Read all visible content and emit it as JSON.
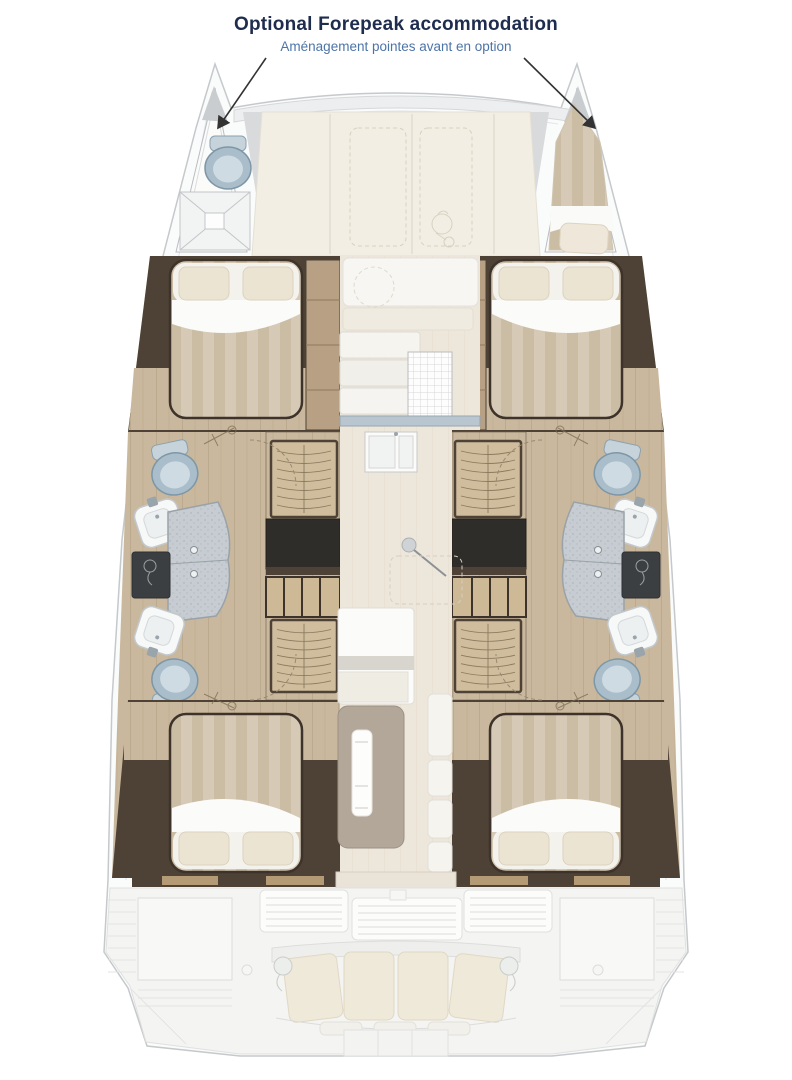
{
  "annotation": {
    "title": "Optional Forepeak accommodation",
    "subtitle": "Aménagement pointes avant en option"
  },
  "colors": {
    "title_color": "#1e2c4e",
    "subtitle_color": "#4d74a7",
    "arrow": "#333333",
    "wall": "#4e4236",
    "wood": "#c9b89d",
    "shelf": "#b7a084",
    "salon_floor": "#ece6db",
    "deck_cream": "#f2eee4",
    "hull_fill": "#fafbfb",
    "hull_line": "#c5c9cc",
    "cockpit": "#f4f4f3",
    "cushion": "#efe9da",
    "table": "#b3a79a",
    "counter_blue": "#b9c6cf",
    "fixture_blue": "#a9bdca",
    "panel_dark": "#3c3f41"
  }
}
